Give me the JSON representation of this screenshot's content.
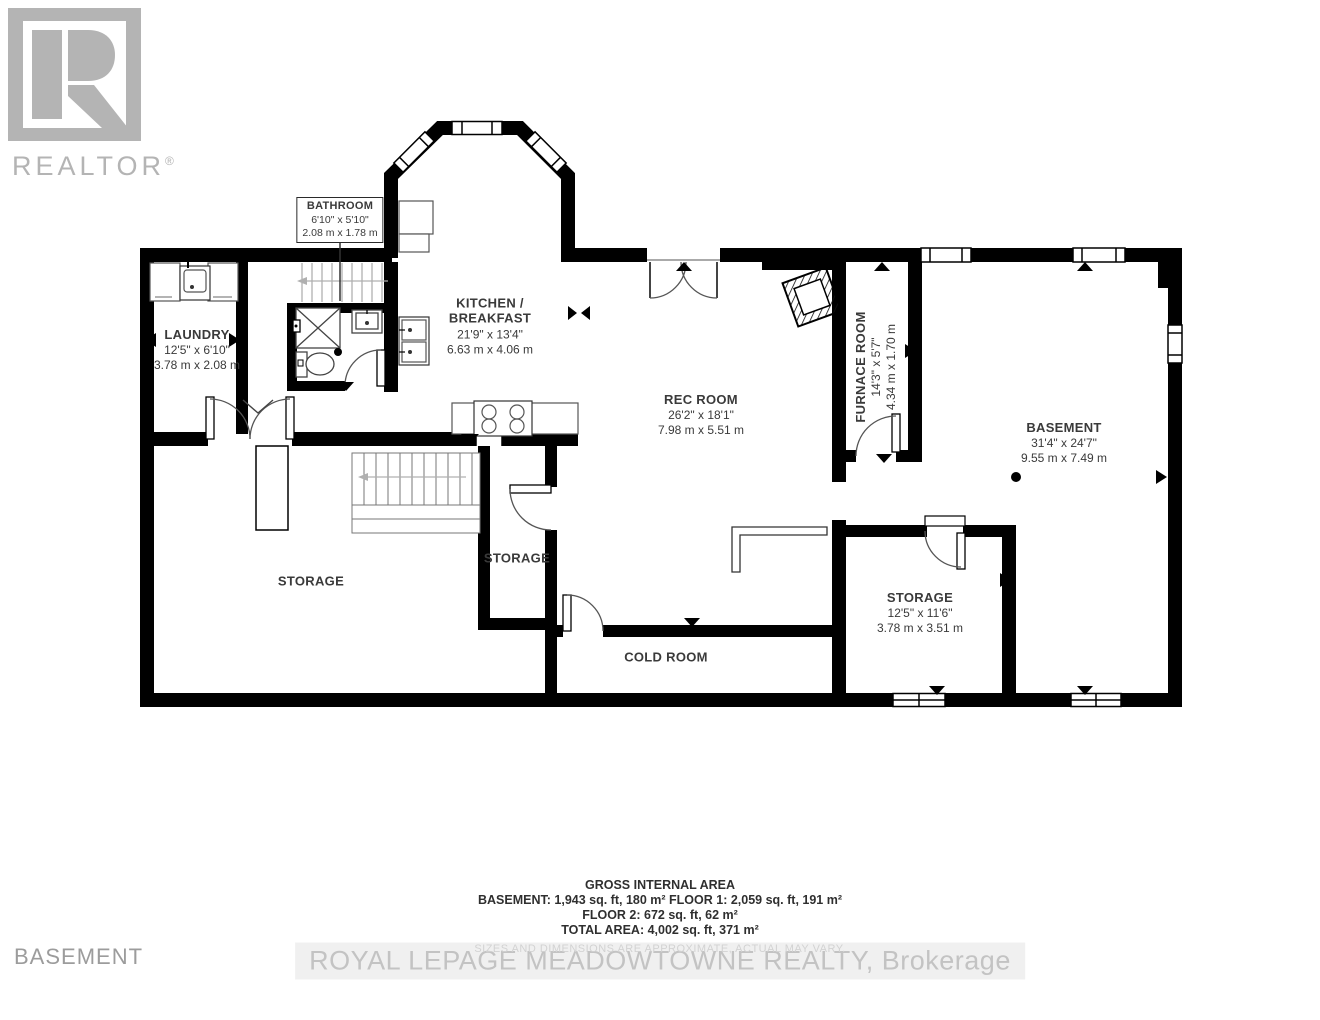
{
  "branding": {
    "logo_text": "REALTOR",
    "registered_mark": "®"
  },
  "floor_title": "BASEMENT",
  "watermark": "ROYAL LEPAGE MEADOWTOWNE REALTY, Brokerage",
  "disclaimer": "SIZES AND DIMENSIONS ARE APPROXIMATE, ACTUAL MAY VARY.",
  "area_summary": {
    "title": "GROSS INTERNAL AREA",
    "line1": "BASEMENT: 1,943 sq. ft, 180 m² FLOOR 1: 2,059 sq. ft, 191 m²",
    "line2": "FLOOR 2: 672 sq. ft, 62 m²",
    "line3": "TOTAL AREA: 4,002 sq. ft, 371 m²"
  },
  "rooms": {
    "bathroom": {
      "name": "BATHROOM",
      "imperial": "6'10\" x 5'10\"",
      "metric": "2.08 m x 1.78 m"
    },
    "laundry": {
      "name": "LAUNDRY",
      "imperial": "12'5\" x 6'10\"",
      "metric": "3.78 m x 2.08 m"
    },
    "kitchen": {
      "name_line1": "KITCHEN /",
      "name_line2": "BREAKFAST",
      "imperial": "21'9\" x 13'4\"",
      "metric": "6.63 m x 4.06 m"
    },
    "rec_room": {
      "name": "REC ROOM",
      "imperial": "26'2\" x 18'1\"",
      "metric": "7.98 m x 5.51 m"
    },
    "furnace_room": {
      "name": "FURNACE ROOM",
      "imperial": "14'3\" x 5'7\"",
      "metric": "4.34 m x 1.70 m"
    },
    "basement": {
      "name": "BASEMENT",
      "imperial": "31'4\" x 24'7\"",
      "metric": "9.55 m x 7.49 m"
    },
    "storage_left": {
      "name": "STORAGE"
    },
    "storage_mid": {
      "name": "STORAGE"
    },
    "storage_right": {
      "name": "STORAGE",
      "imperial": "12'5\" x 11'6\"",
      "metric": "3.78 m x 3.51 m"
    },
    "cold_room": {
      "name": "COLD ROOM"
    }
  },
  "colors": {
    "wall": "#000000",
    "logo_gray": "#b4b4b4",
    "label_text": "#3a3a3a",
    "muted_text": "#9c9c9c",
    "watermark_text": "#c3c3c3"
  }
}
